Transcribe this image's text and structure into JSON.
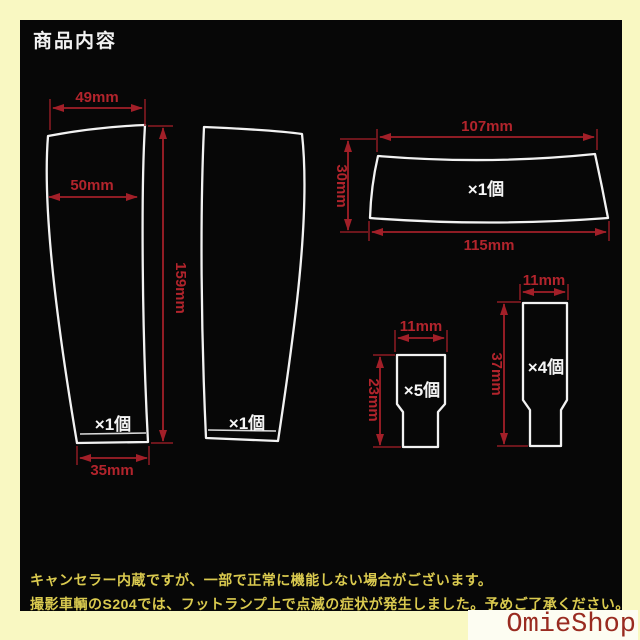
{
  "title": "商品内容",
  "colors": {
    "border_background": "#f9f8c2",
    "panel_background": "#070707",
    "shape_outline": "#f2f2f2",
    "dimension_red": "#a21f28",
    "footer_yellow": "#daca4f",
    "watermark_red": "#992b20",
    "watermark_background": "#fdfdf2"
  },
  "pieces": {
    "left_pillar": {
      "top_width": "49mm",
      "upper_width": "50mm",
      "height": "159mm",
      "bottom_width": "35mm",
      "quantity": "×1個"
    },
    "right_pillar": {
      "quantity": "×1個"
    },
    "wide_panel": {
      "top_width": "107mm",
      "height": "30mm",
      "bottom_width": "115mm",
      "quantity": "×1個"
    },
    "small_tab": {
      "width": "11mm",
      "height": "23mm",
      "quantity": "×5個"
    },
    "tall_tab": {
      "width": "11mm",
      "height": "37mm",
      "quantity": "×4個"
    }
  },
  "footer": {
    "line1": "キャンセラー内蔵ですが、一部で正常に機能しない場合がございます。",
    "line2": "撮影車輌のS204では、フットランプ上で点滅の症状が発生しました。予めご了承ください。"
  },
  "watermark": "OmieShop"
}
